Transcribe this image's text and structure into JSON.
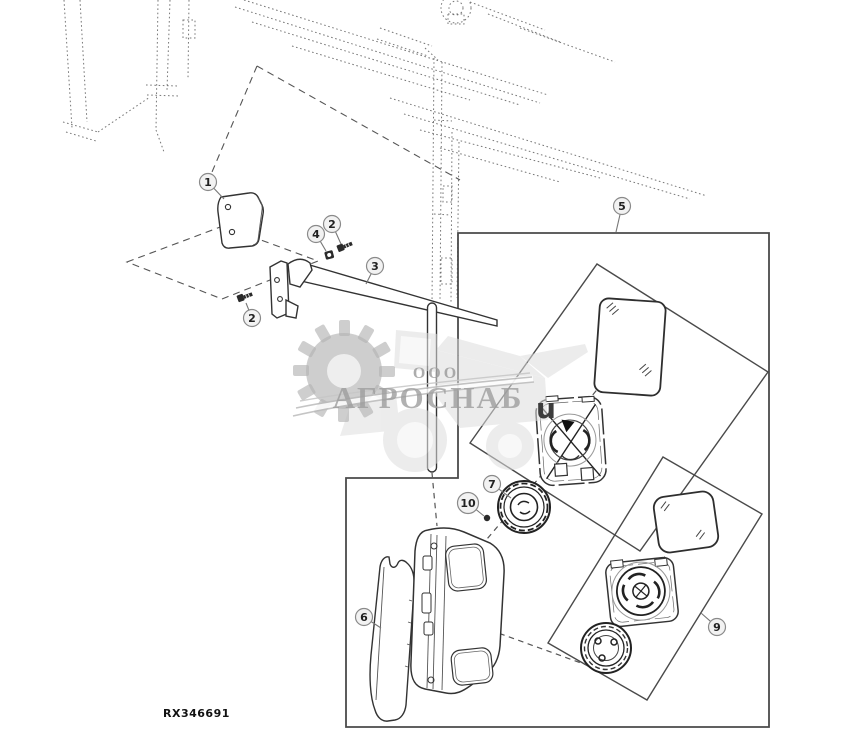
{
  "figure": {
    "code": "RX346691"
  },
  "watermark": {
    "org_form": "ООО",
    "company": "АГРОСНАБ",
    "stray_glyph": "u",
    "gear_color": "#b3b3b3",
    "text_color": "#9e9e9e"
  },
  "callouts": [
    {
      "label": "1",
      "x": 208,
      "y": 182,
      "tx": 224,
      "ty": 199
    },
    {
      "label": "2",
      "x": 332,
      "y": 224,
      "tx": 341,
      "ty": 244
    },
    {
      "label": "4",
      "x": 316,
      "y": 234,
      "tx": 326,
      "ty": 251
    },
    {
      "label": "3",
      "x": 375,
      "y": 266,
      "tx": 366,
      "ty": 284
    },
    {
      "label": "2",
      "x": 252,
      "y": 318,
      "tx": 246,
      "ty": 303
    },
    {
      "label": "5",
      "x": 622,
      "y": 206,
      "tx": 616,
      "ty": 232
    },
    {
      "label": "10",
      "x": 468,
      "y": 503,
      "tx": 484,
      "ty": 516
    },
    {
      "label": "7",
      "x": 492,
      "y": 484,
      "tx": 511,
      "ty": 498
    },
    {
      "label": "6",
      "x": 364,
      "y": 617,
      "tx": 381,
      "ty": 628
    },
    {
      "label": "9",
      "x": 717,
      "y": 627,
      "tx": 701,
      "ty": 613
    }
  ]
}
